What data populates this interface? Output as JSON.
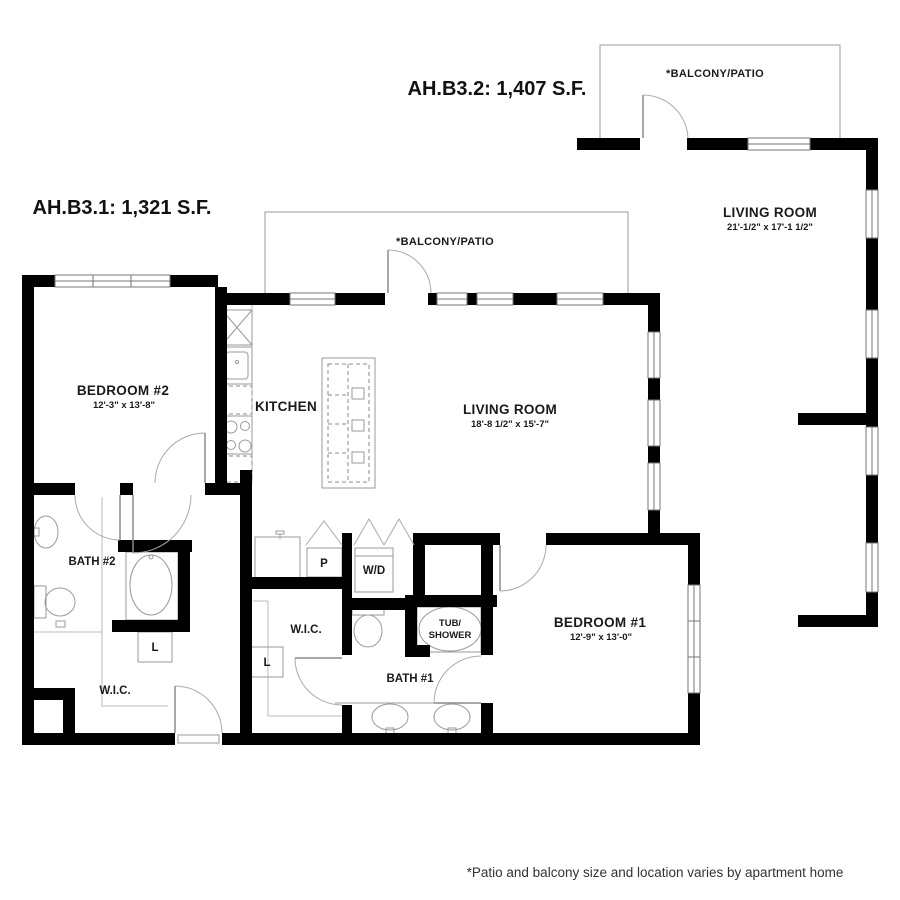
{
  "unit1": {
    "title": "AH.B3.1: 1,321 S.F.",
    "balcony_label": "*BALCONY/PATIO",
    "bedroom2": {
      "name": "BEDROOM #2",
      "dims": "12'-3\" x 13'-8\""
    },
    "kitchen": "KITCHEN",
    "living": {
      "name": "LIVING ROOM",
      "dims": "18'-8 1/2\" x 15'-7\""
    },
    "bath2": "BATH #2",
    "bath1": "BATH #1",
    "bedroom1": {
      "name": "BEDROOM #1",
      "dims": "12'-9\" x 13'-0\""
    },
    "wic_left": "W.I.C.",
    "wic_mid": "W.I.C.",
    "linen_left": "L",
    "linen_mid": "L",
    "pantry": "P",
    "washer_dryer": "W/D",
    "tub_shower": {
      "line1": "TUB/",
      "line2": "SHOWER"
    }
  },
  "unit2": {
    "title": "AH.B3.2: 1,407 S.F.",
    "balcony_label": "*BALCONY/PATIO",
    "living": {
      "name": "LIVING ROOM",
      "dims": "21'-1/2\" x 17'-1 1/2\""
    }
  },
  "footnote": "*Patio and balcony size and location varies by apartment home",
  "colors": {
    "wall": "#000000",
    "outline": "#999999",
    "text": "#1a1a1a"
  }
}
